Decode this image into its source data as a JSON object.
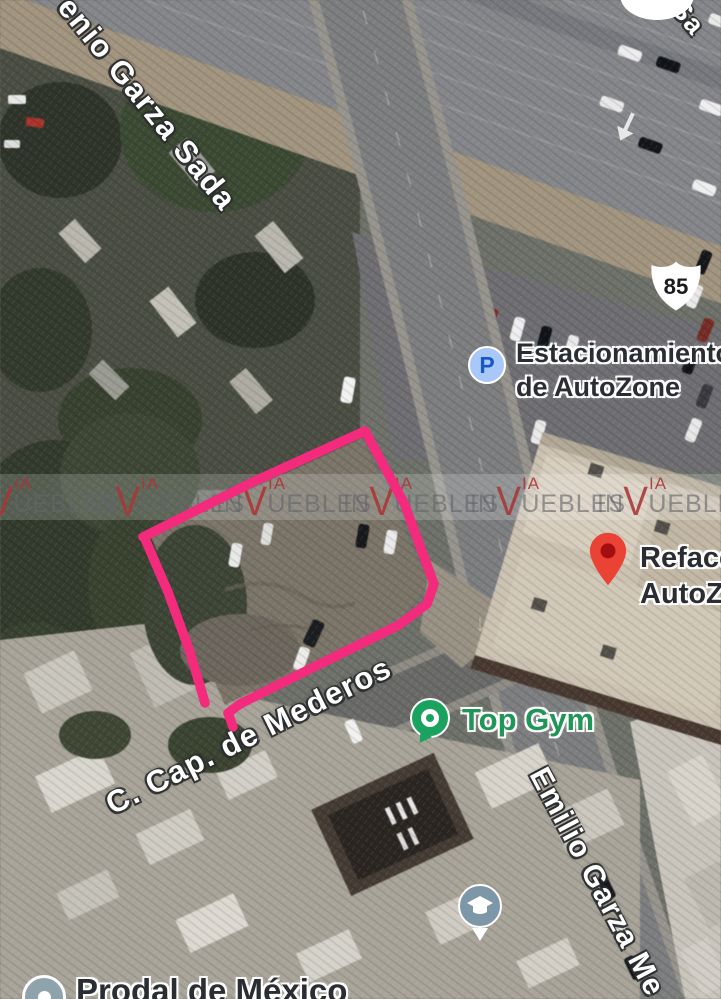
{
  "map": {
    "watermark": {
      "band_text_prefix": "IN",
      "band_text_v": "V",
      "band_text_suffix": "UEBLES",
      "band_via": "IA",
      "red_color": "#A83636"
    },
    "streets": {
      "garza_sada": "enio Garza Sada",
      "mederos": "C. Cap. de Mederos",
      "emilio": "Emilio Garza Me",
      "partial_sa": "Sa"
    },
    "route_shield": {
      "number": "85"
    },
    "pois": {
      "parking": {
        "icon": "parking-icon",
        "icon_letter": "P",
        "line1": "Estacionamiento",
        "line2": "de AutoZone"
      },
      "refacciones": {
        "icon": "red-map-pin-icon",
        "line1": "Refacco",
        "line2": "AutoZo"
      },
      "top_gym": {
        "icon": "gym-pin-icon",
        "label": "Top Gym"
      },
      "education": {
        "icon": "school-pin-icon"
      },
      "prodal": {
        "icon": "generic-poi-icon",
        "label": "Prodal de México"
      }
    },
    "highlight": {
      "color": "#F42A7D",
      "path": "M143,537 L255,481 L365,431 L404,503 L434,584 L427,604 L399,625 L310,669 L240,704 L228,713 L233,727 M145,539 L168,592 L190,652 L205,703"
    },
    "colors": {
      "highlight_pink": "#F42A7D",
      "watermark_red": "#A83636",
      "pin_red": "#EA4335",
      "gym_green": "#1AA35E",
      "gym_text_green": "#1F9656",
      "parking_icon_bg": "#A9C7F8",
      "parking_icon_letter": "#1558C9",
      "generic_poi_gray": "#8FA3AD",
      "education_poi_gray": "#7D96A8",
      "road_gray": "#7D7E80",
      "lot_dirt": "#7C7467"
    }
  }
}
